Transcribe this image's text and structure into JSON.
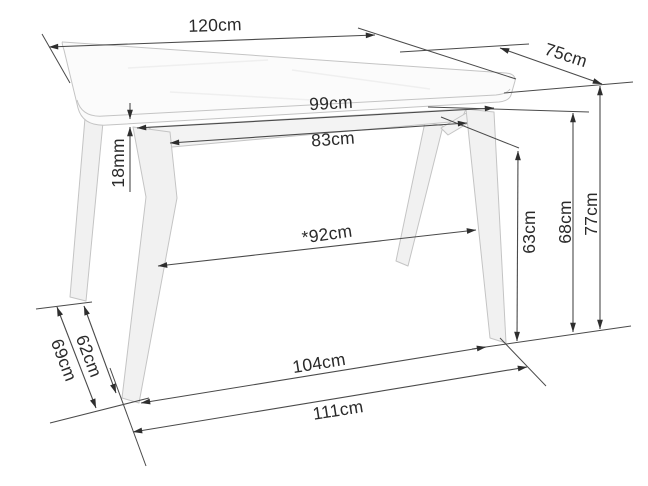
{
  "diagram": {
    "subject": "dining-table-dimension-drawing",
    "units": [
      "cm",
      "mm"
    ]
  },
  "labels": {
    "d120": "120cm",
    "d75": "75cm",
    "d99": "99cm",
    "d83": "83cm",
    "d18": "18mm",
    "d92": "*92cm",
    "d63": "63cm",
    "d68": "68cm",
    "d77": "77cm",
    "d62": "62cm",
    "d69": "69cm",
    "d104": "104cm",
    "d111": "111cm"
  },
  "colors": {
    "bg": "#ffffff",
    "ink": "#2a2a2a",
    "dimline": "#4a4a4a",
    "arrow": "#2e2e2e",
    "furniture-outline": "#c4c4c4",
    "furniture-fill": "#fbfbfb",
    "leg-fill": "#f1f1f1",
    "apron-fill": "#f3f3f3"
  }
}
